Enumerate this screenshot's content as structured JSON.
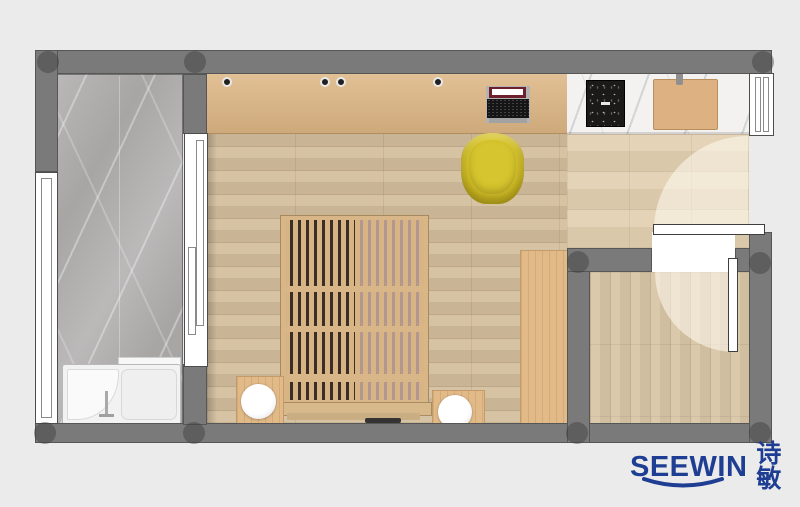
{
  "brand": {
    "logo_text": "SEEWIN",
    "logo_cjk": "诗敏"
  },
  "palette": {
    "background": "#ecebeb",
    "wall": "#7a7a7a",
    "balcony_marble": "#a8a5a5",
    "main_floor": "#d4bf9e",
    "entry_floor": "#e2d0b0",
    "room_floor": "#d9c6a6",
    "cabinet_wood": "#ddb684",
    "slat_wood": "#d9b687",
    "kitchen_marble": "#f3f2f0",
    "cooktop": "#1b1a19",
    "chair_accent": "#c9b51f",
    "logo_navy": "#1e3e93"
  },
  "elements": [
    "outer-walls",
    "structural-columns",
    "balcony-marble-floor",
    "balcony-sliding-door",
    "left-window",
    "walk-in-bathtub",
    "main-room-wood-floor",
    "wardrobe-counter",
    "laptop",
    "desk-chair",
    "slatted-platform-bed",
    "nightstand-left",
    "nightstand-right",
    "bedside-lamp-left",
    "bedside-lamp-right",
    "side-cabinet",
    "kitchen-counter",
    "cooktop",
    "cutting-board",
    "right-window",
    "entry-door",
    "entry-door-swing",
    "hallway-floor",
    "interior-door",
    "interior-door-swing",
    "small-room-floor"
  ]
}
